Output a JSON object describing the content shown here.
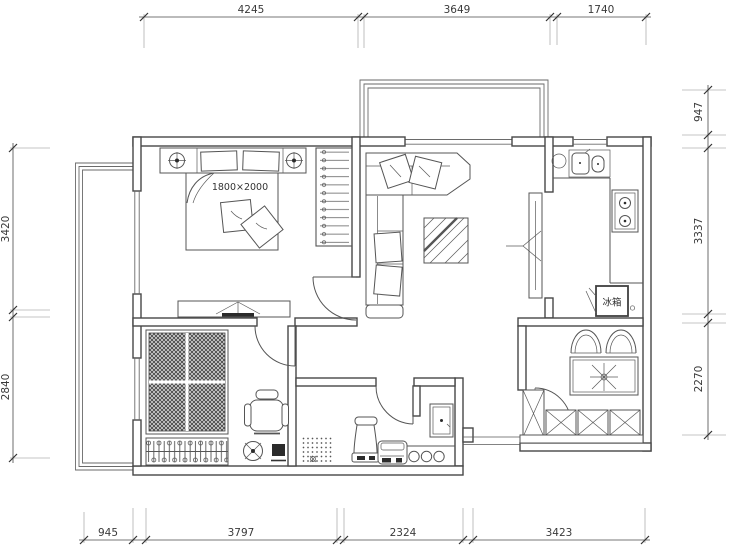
{
  "drawing": {
    "type": "residential floor plan",
    "bed_size_label": "1800×2000",
    "fridge_label": "冰箱"
  },
  "dimensions": {
    "top": [
      "4245",
      "3649",
      "1740"
    ],
    "bottom": [
      "945",
      "3797",
      "2324",
      "3423"
    ],
    "left": [
      "3420",
      "2840"
    ],
    "right": [
      "947",
      "3337",
      "2270"
    ]
  },
  "colors": {
    "background": "#ffffff",
    "wall_line": "#474747",
    "furniture_line": "#555555",
    "dimension_text": "#3a3a3a",
    "dark_fill": "#2b2b2b"
  }
}
